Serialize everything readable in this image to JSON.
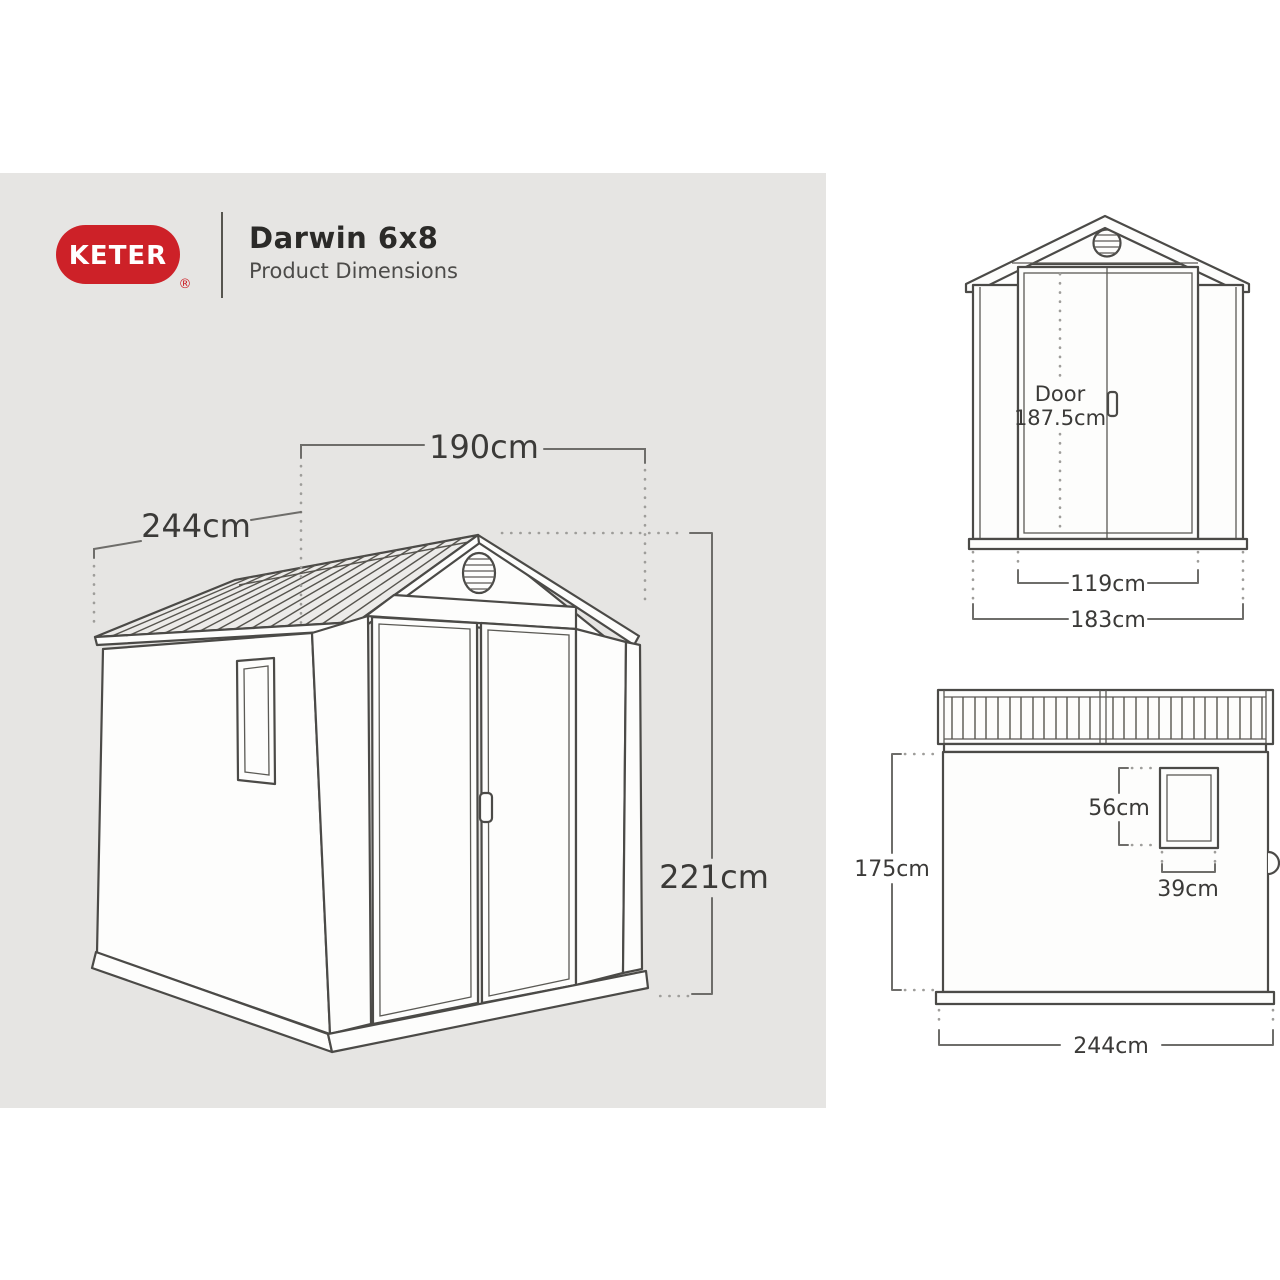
{
  "header": {
    "brand": "KETER",
    "registered": "®",
    "title": "Darwin 6x8",
    "subtitle": "Product Dimensions"
  },
  "colors": {
    "brand_red": "#cd2128",
    "panel_gray": "#e6e5e3",
    "line_dark": "#4b4a47",
    "dim_text": "#3b3a38"
  },
  "perspective_view": {
    "width_label": "190cm",
    "depth_label": "244cm",
    "height_label": "221cm"
  },
  "front_view": {
    "door_label": "Door",
    "door_height_label": "187.5cm",
    "door_width_label": "119cm",
    "overall_width_label": "183cm"
  },
  "side_view": {
    "window_height_label": "56cm",
    "window_width_label": "39cm",
    "wall_height_label": "175cm",
    "depth_label": "244cm"
  }
}
